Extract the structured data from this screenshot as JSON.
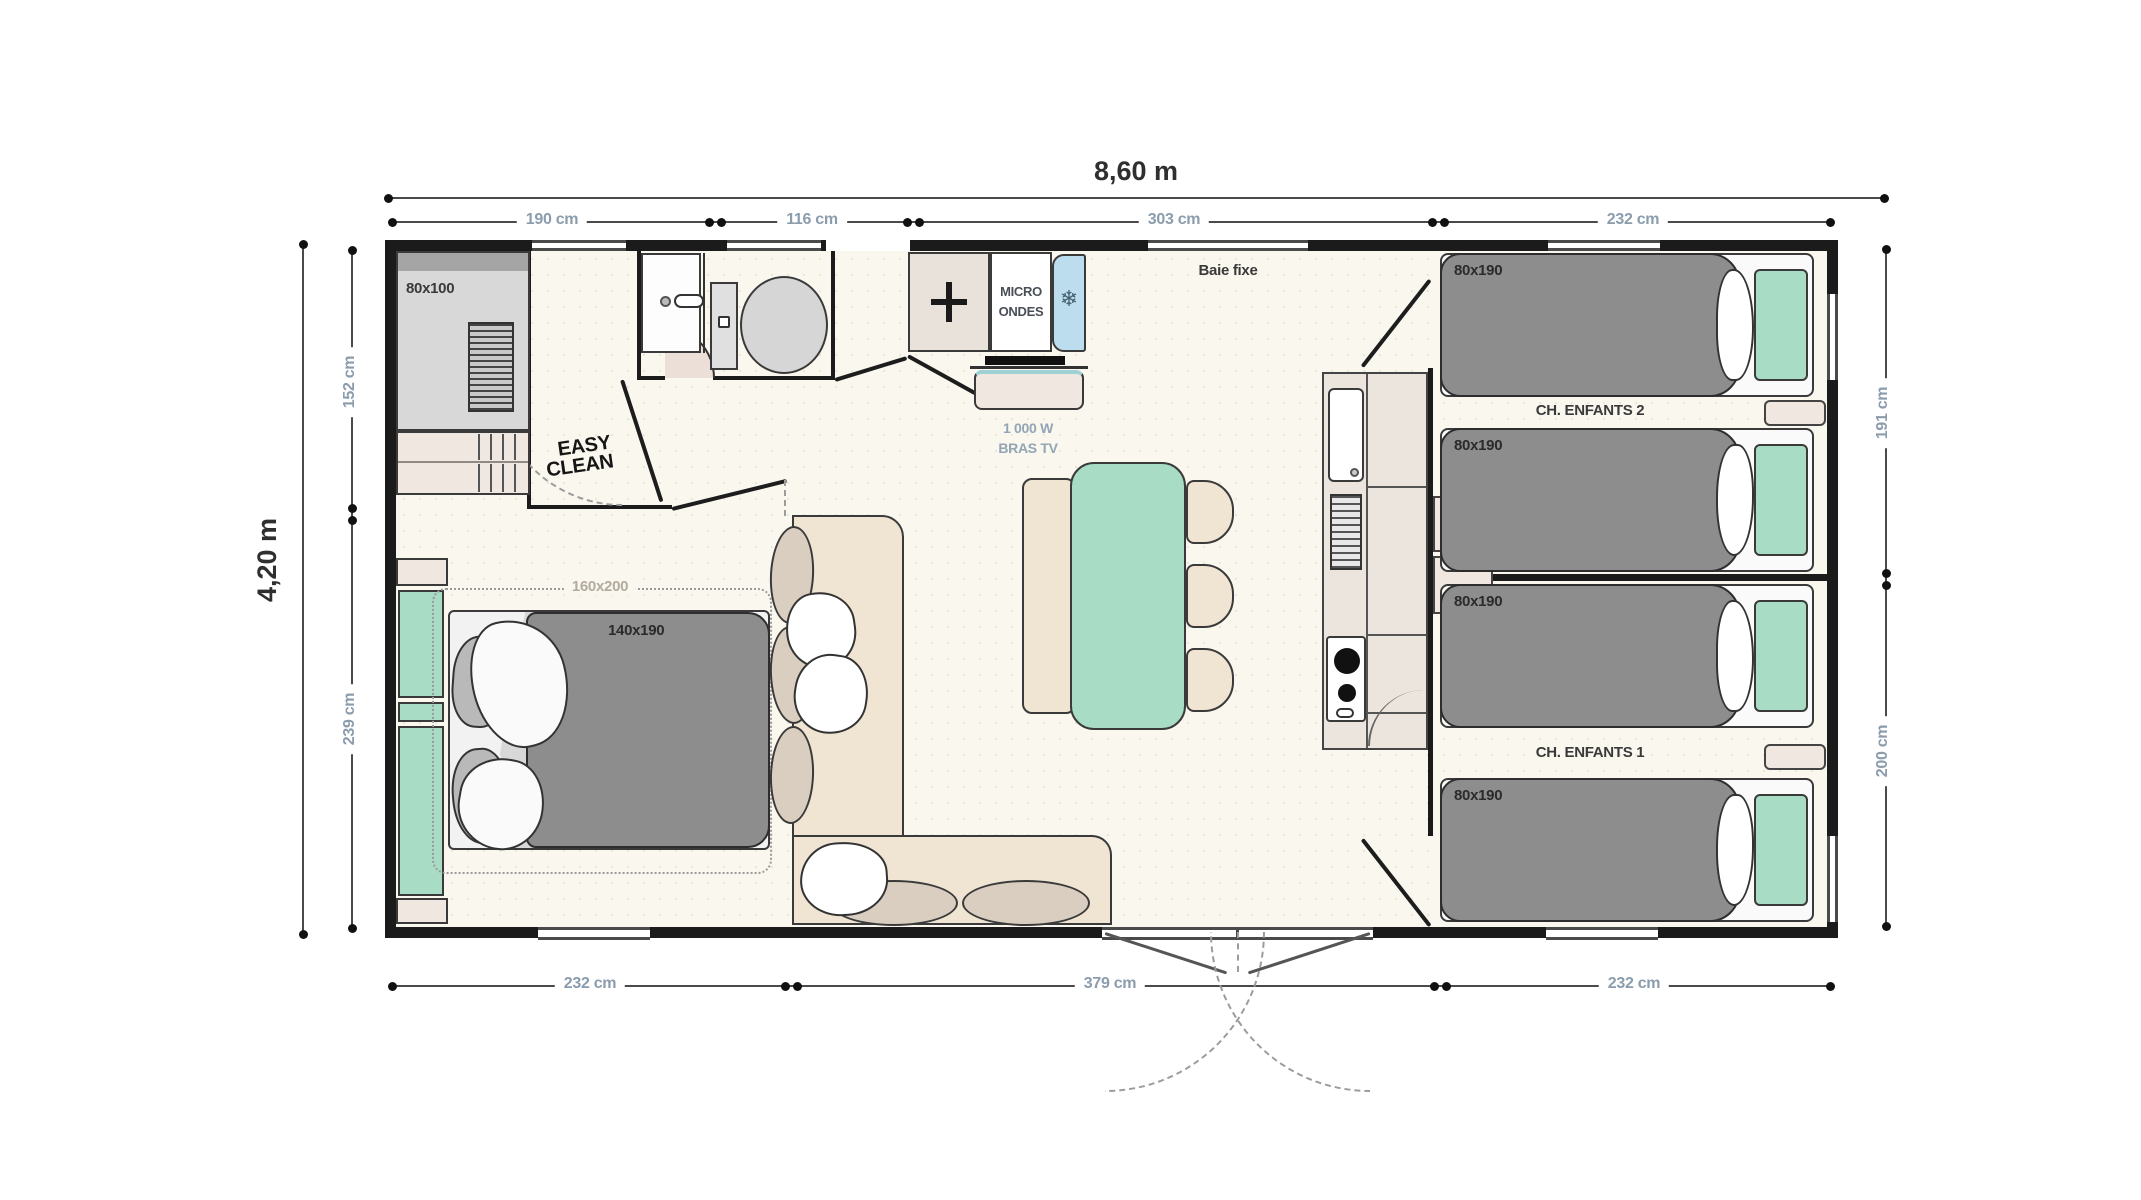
{
  "plan": {
    "dimensions": {
      "width_total": "8,60 m",
      "height_total": "4,20 m",
      "top_segments": [
        "190 cm",
        "116 cm",
        "303 cm",
        "232 cm"
      ],
      "bottom_segments": [
        "232 cm",
        "379 cm",
        "232 cm"
      ],
      "left_segments": [
        "152 cm",
        "239 cm"
      ],
      "right_segments": [
        "191 cm",
        "200 cm"
      ]
    },
    "rooms": {
      "children_room_2_label": "CH. ENFANTS 2",
      "children_room_1_label": "CH. ENFANTS 1"
    },
    "furniture_labels": {
      "shower_size": "80x100",
      "double_bed_size": "140x190",
      "double_bed_outline_size": "160x200",
      "single_bed_size": "80x190",
      "fixed_window": "Baie fixe",
      "microwave_line_1": "MICRO",
      "microwave_line_2": "ONDES",
      "tv_power": "1 000 W",
      "tv_bracket": "BRAS TV",
      "easy_clean_line_1": "EASY",
      "easy_clean_line_2": "CLEAN"
    },
    "icons": {
      "fridge_glyph": "❄"
    },
    "colors": {
      "accent_mint": "#a9dcc5",
      "furniture_beige": "#f0e4d2",
      "mattress_gray": "#8d8d8d",
      "fridge_blue": "#bcdded",
      "wall": "#1b1b1b",
      "dimension_text": "#8b9cad",
      "floor": "#f9f7ee"
    }
  }
}
